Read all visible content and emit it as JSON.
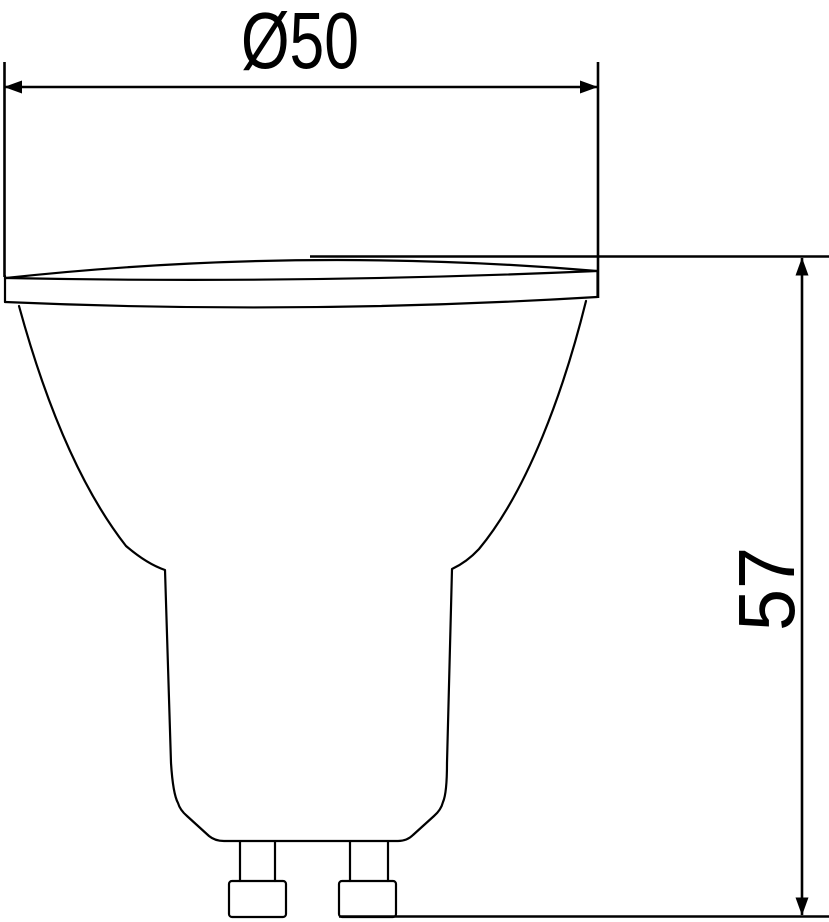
{
  "canvas": {
    "width": 829,
    "height": 922,
    "background": "#ffffff",
    "line_color": "#000000"
  },
  "drawing": {
    "type": "technical-dimension-drawing",
    "object": "GU10 spotlight lamp outline, side view",
    "dimensions": {
      "diameter": {
        "label": "Ø50",
        "value": 50,
        "orientation": "horizontal"
      },
      "height": {
        "label": "57",
        "value": 57,
        "orientation": "vertical"
      }
    }
  }
}
